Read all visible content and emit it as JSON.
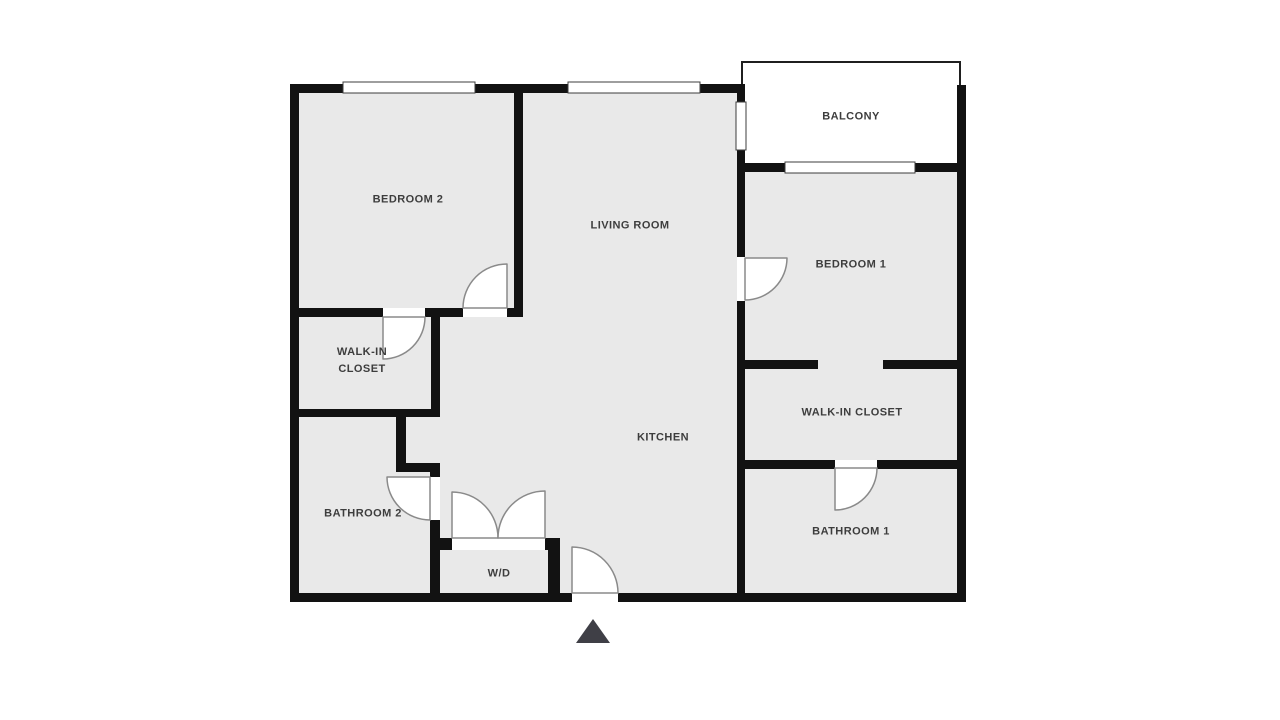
{
  "title": "Apartment Floor Plan",
  "colors": {
    "page_background": "#ffffff",
    "room_fill": "#e9e9e9",
    "wall": "#121212",
    "door_line": "#8a8a8a",
    "door_fill": "#ffffff",
    "window_fill": "#ffffff",
    "window_stroke": "#3c3c3c",
    "sill_fill": "#ffffff",
    "balcony_fill": "#ffffff",
    "balcony_border": "#1f1f1f",
    "label_text": "#3d3d3d",
    "entry_marker": "#3f3f46"
  },
  "rooms": [
    {
      "id": "bedroom-2",
      "label": "BEDROOM 2",
      "cx": 408,
      "cy": 200,
      "w": 140
    },
    {
      "id": "living-room",
      "label": "LIVING ROOM",
      "cx": 630,
      "cy": 226,
      "w": 160
    },
    {
      "id": "balcony",
      "label": "BALCONY",
      "cx": 851,
      "cy": 117,
      "w": 120
    },
    {
      "id": "bedroom-1",
      "label": "BEDROOM 1",
      "cx": 851,
      "cy": 265,
      "w": 140
    },
    {
      "id": "walk-in-closet-2",
      "label": "WALK-IN CLOSET",
      "cx": 362,
      "cy": 361,
      "w": 90
    },
    {
      "id": "kitchen",
      "label": "KITCHEN",
      "cx": 663,
      "cy": 438,
      "w": 120
    },
    {
      "id": "walk-in-closet-1",
      "label": "WALK-IN CLOSET",
      "cx": 852,
      "cy": 413,
      "w": 170
    },
    {
      "id": "bathroom-2",
      "label": "BATHROOM 2",
      "cx": 363,
      "cy": 514,
      "w": 140
    },
    {
      "id": "bathroom-1",
      "label": "BATHROOM 1",
      "cx": 851,
      "cy": 532,
      "w": 140
    },
    {
      "id": "washer-dryer",
      "label": "W/D",
      "cx": 499,
      "cy": 574,
      "w": 60
    }
  ],
  "plan": {
    "canvas": {
      "width": 1280,
      "height": 720
    },
    "base": {
      "name": "unit-interior",
      "x": 294,
      "y": 88,
      "w": 668,
      "h": 510
    },
    "balcony": {
      "name": "balcony-deck",
      "x": 742,
      "y": 62,
      "w": 218,
      "h": 105
    },
    "walls": [
      {
        "name": "outer-top-wall",
        "x": 290,
        "y": 84,
        "w": 455,
        "h": 9
      },
      {
        "name": "outer-left-wall",
        "x": 290,
        "y": 84,
        "w": 9,
        "h": 518
      },
      {
        "name": "outer-bottom-wall",
        "x": 290,
        "y": 593,
        "w": 676,
        "h": 9
      },
      {
        "name": "outer-right-wall",
        "x": 957,
        "y": 85,
        "w": 9,
        "h": 517
      },
      {
        "name": "balcony-bottom-wall",
        "x": 737,
        "y": 163,
        "w": 229,
        "h": 9
      },
      {
        "name": "balcony-left-wall",
        "x": 737,
        "y": 84,
        "w": 8,
        "h": 79
      },
      {
        "name": "bedroom2-living-wall",
        "x": 514,
        "y": 84,
        "w": 9,
        "h": 233
      },
      {
        "name": "bedroom2-closet-wall-a",
        "x": 290,
        "y": 308,
        "w": 93,
        "h": 9
      },
      {
        "name": "bedroom2-closet-wall-b",
        "x": 425,
        "y": 308,
        "w": 38,
        "h": 9
      },
      {
        "name": "bedroom2-closet-wall-c",
        "x": 507,
        "y": 308,
        "w": 16,
        "h": 9
      },
      {
        "name": "closet2-right-wall",
        "x": 431,
        "y": 308,
        "w": 9,
        "h": 109
      },
      {
        "name": "bathroom2-top-wall",
        "x": 290,
        "y": 409,
        "w": 150,
        "h": 8
      },
      {
        "name": "bathroom2-right-wall-upper",
        "x": 396,
        "y": 417,
        "w": 10,
        "h": 48
      },
      {
        "name": "bathroom2-jog-wall",
        "x": 396,
        "y": 463,
        "w": 44,
        "h": 9
      },
      {
        "name": "bathroom2-right-wall-mid",
        "x": 430,
        "y": 471,
        "w": 10,
        "h": 6
      },
      {
        "name": "bathroom2-right-wall-lower",
        "x": 430,
        "y": 520,
        "w": 10,
        "h": 82
      },
      {
        "name": "wd-top-wall-left",
        "x": 430,
        "y": 538,
        "w": 22,
        "h": 12
      },
      {
        "name": "wd-top-wall-right",
        "x": 545,
        "y": 538,
        "w": 15,
        "h": 12
      },
      {
        "name": "wd-right-wall",
        "x": 548,
        "y": 538,
        "w": 12,
        "h": 64
      },
      {
        "name": "kitchen-right-wall-upper",
        "x": 737,
        "y": 172,
        "w": 8,
        "h": 85
      },
      {
        "name": "kitchen-right-wall-lower",
        "x": 737,
        "y": 301,
        "w": 8,
        "h": 293
      },
      {
        "name": "bedroom1-closet-wall-left",
        "x": 737,
        "y": 360,
        "w": 81,
        "h": 9
      },
      {
        "name": "bedroom1-closet-wall-right",
        "x": 883,
        "y": 360,
        "w": 83,
        "h": 9
      },
      {
        "name": "closet1-bathroom1-wall-left",
        "x": 737,
        "y": 460,
        "w": 98,
        "h": 9
      },
      {
        "name": "closet1-bathroom1-wall-right",
        "x": 877,
        "y": 460,
        "w": 89,
        "h": 9
      }
    ],
    "windows": [
      {
        "name": "bedroom2-window",
        "x": 343,
        "y": 82,
        "w": 132,
        "h": 11
      },
      {
        "name": "living-room-window",
        "x": 568,
        "y": 82,
        "w": 132,
        "h": 11
      },
      {
        "name": "balcony-slider-window",
        "x": 785,
        "y": 162,
        "w": 130,
        "h": 11
      },
      {
        "name": "balcony-side-window",
        "x": 736,
        "y": 102,
        "w": 10,
        "h": 48
      }
    ],
    "door_sills": [
      {
        "name": "bedroom1-door-sill",
        "x": 737,
        "y": 257,
        "w": 8,
        "h": 44
      },
      {
        "name": "closet2-door-sill",
        "x": 383,
        "y": 308,
        "w": 42,
        "h": 9
      },
      {
        "name": "bedroom2-door-sill",
        "x": 463,
        "y": 308,
        "w": 44,
        "h": 9
      },
      {
        "name": "bathroom2-door-sill",
        "x": 430,
        "y": 477,
        "w": 10,
        "h": 43
      },
      {
        "name": "bathroom1-door-sill",
        "x": 835,
        "y": 460,
        "w": 42,
        "h": 9
      },
      {
        "name": "entry-door-sill",
        "x": 572,
        "y": 592,
        "w": 46,
        "h": 11
      },
      {
        "name": "wd-door-sill",
        "x": 452,
        "y": 538,
        "w": 93,
        "h": 12
      }
    ],
    "doors": [
      {
        "name": "bedroom2-door",
        "path": "M 507 308 L 507 264 A 44 44 0 0 0 463 308 Z"
      },
      {
        "name": "closet2-door",
        "path": "M 383 317 L 383 359 A 42 42 0 0 0 425 317 Z"
      },
      {
        "name": "bedroom1-door",
        "path": "M 745 258 L 787 258 A 42 42 0 0 1 745 300 Z"
      },
      {
        "name": "bathroom2-door",
        "path": "M 430 477 L 387 477 A 43 43 0 0 0 430 520 Z"
      },
      {
        "name": "bathroom1-door",
        "path": "M 835 468 L 835 510 A 42 42 0 0 0 877 468 Z"
      },
      {
        "name": "entry-door",
        "path": "M 572 593 L 572 547 A 46 46 0 0 1 618 593 Z"
      },
      {
        "name": "wd-door-left",
        "path": "M 452 538 L 452 492 A 46 46 0 0 1 498 538 Z"
      },
      {
        "name": "wd-door-right",
        "path": "M 545 538 L 545 491 A 47 47 0 0 0 498 538 Z"
      }
    ],
    "entry_marker": {
      "name": "entry-arrow",
      "points": "593,619 576,643 610,643"
    }
  }
}
